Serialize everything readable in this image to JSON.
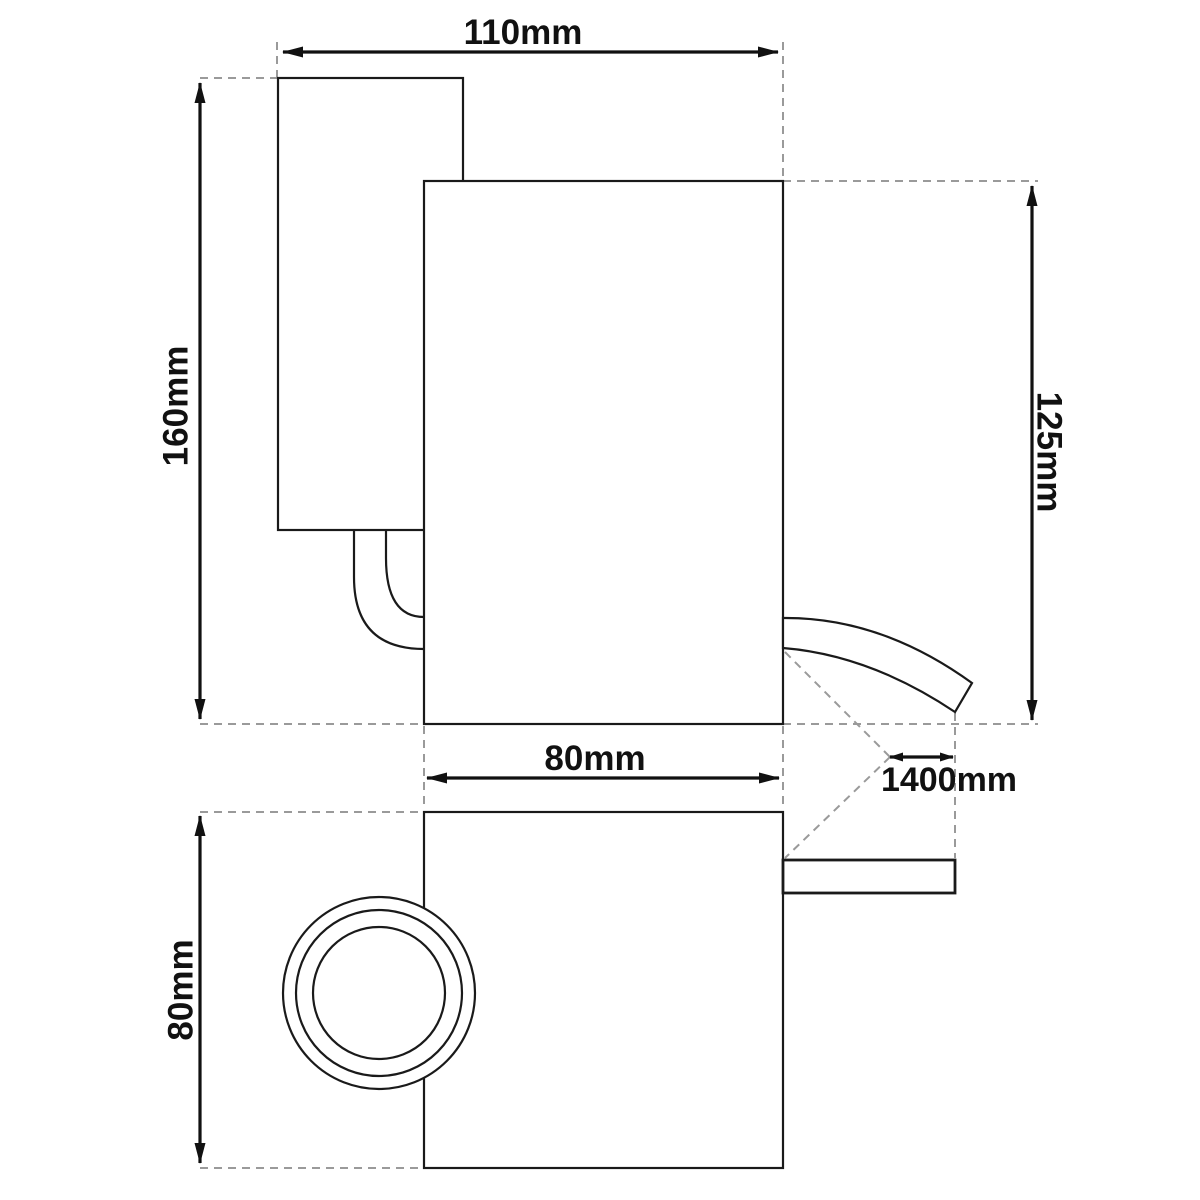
{
  "dimensions": {
    "overall_width": "110mm",
    "overall_height": "160mm",
    "body_height": "125mm",
    "body_width": "80mm",
    "cable_length": "1400mm",
    "base_height": "80mm"
  },
  "colors": {
    "outline": "#1a1a1a",
    "dimension_line": "#111111",
    "extension_line": "#9a9a9a",
    "background": "#ffffff"
  }
}
